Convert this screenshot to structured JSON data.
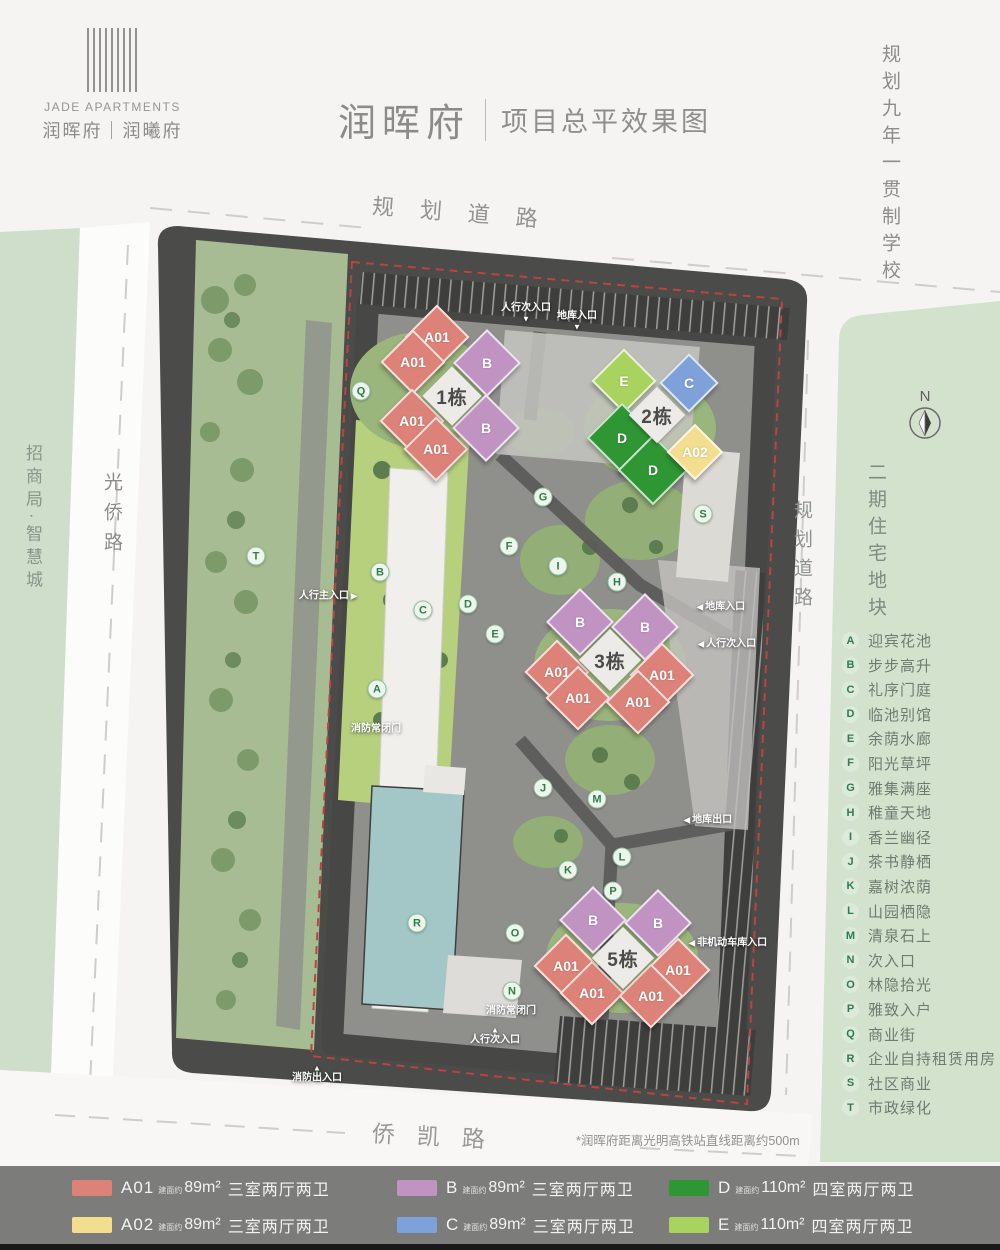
{
  "header": {
    "logo_en": "JADE APARTMENTS",
    "logo_cn": "润晖府｜润曦府",
    "title": "润晖府",
    "subtitle": "项目总平效果图"
  },
  "roads": {
    "top": "规划道路",
    "bottom": "侨凯路",
    "left": "光侨路",
    "right": "规划道路"
  },
  "areas": {
    "school": "规划九年一贯制学校",
    "east_block": "二期住宅地块",
    "west_block": "招商局·智慧城"
  },
  "compass_label": "N",
  "note": "*润晖府距离光明高铁站直线距离约500m",
  "legend": {
    "amenities": [
      {
        "key": "A",
        "label": "迎宾花池"
      },
      {
        "key": "B",
        "label": "步步高升"
      },
      {
        "key": "C",
        "label": "礼序门庭"
      },
      {
        "key": "D",
        "label": "临池别馆"
      },
      {
        "key": "E",
        "label": "余荫水廊"
      },
      {
        "key": "F",
        "label": "阳光草坪"
      },
      {
        "key": "G",
        "label": "雅集满座"
      },
      {
        "key": "H",
        "label": "稚童天地"
      },
      {
        "key": "I",
        "label": "香兰幽径"
      },
      {
        "key": "J",
        "label": "茶书静栖"
      },
      {
        "key": "K",
        "label": "嘉树浓荫"
      },
      {
        "key": "L",
        "label": "山园栖隐"
      },
      {
        "key": "M",
        "label": "清泉石上"
      },
      {
        "key": "N",
        "label": "次入口"
      },
      {
        "key": "O",
        "label": "林隐拾光"
      },
      {
        "key": "P",
        "label": "雅致入户"
      },
      {
        "key": "Q",
        "label": "商业街"
      },
      {
        "key": "R",
        "label": "企业自持租赁用房"
      },
      {
        "key": "S",
        "label": "社区商业"
      },
      {
        "key": "T",
        "label": "市政绿化"
      }
    ],
    "units": [
      {
        "code": "A01",
        "prefix": "建面约",
        "area": "89m²",
        "desc": "三室两厅两卫",
        "color": "#dd8278"
      },
      {
        "code": "B",
        "prefix": "建面约",
        "area": "89m²",
        "desc": "三室两厅两卫",
        "color": "#c093c2"
      },
      {
        "code": "D",
        "prefix": "建面约",
        "area": "110m²",
        "desc": "四室两厅两卫",
        "color": "#2f9634"
      },
      {
        "code": "A02",
        "prefix": "建面约",
        "area": "89m²",
        "desc": "三室两厅两卫",
        "color": "#f3dd8e"
      },
      {
        "code": "C",
        "prefix": "建面约",
        "area": "89m²",
        "desc": "三室两厅两卫",
        "color": "#7ea1da"
      },
      {
        "code": "E",
        "prefix": "建面约",
        "area": "110m²",
        "desc": "四室两厅两卫",
        "color": "#a8d35f"
      }
    ]
  },
  "map": {
    "buildings": [
      {
        "label": "A01",
        "x": 437,
        "y": 337,
        "color": "#dd8278",
        "size": 46
      },
      {
        "label": "A01",
        "x": 413,
        "y": 362,
        "color": "#dd8278",
        "size": 46
      },
      {
        "label": "B",
        "x": 487,
        "y": 363,
        "color": "#c093c2",
        "size": 48
      },
      {
        "label": "A01",
        "x": 412,
        "y": 421,
        "color": "#dd8278",
        "size": 46
      },
      {
        "label": "A01",
        "x": 436,
        "y": 449,
        "color": "#dd8278",
        "size": 46
      },
      {
        "label": "B",
        "x": 486,
        "y": 428,
        "color": "#c093c2",
        "size": 48
      },
      {
        "label": "1栋",
        "x": 452,
        "y": 396,
        "color": "#edebe7",
        "size": 42,
        "cls": "cluster"
      },
      {
        "label": "E",
        "x": 624,
        "y": 381,
        "color": "#a8d35f",
        "size": 46
      },
      {
        "label": "C",
        "x": 689,
        "y": 383,
        "color": "#7ea1da",
        "size": 42
      },
      {
        "label": "D",
        "x": 622,
        "y": 438,
        "color": "#2f9634",
        "size": 50
      },
      {
        "label": "D",
        "x": 653,
        "y": 470,
        "color": "#2f9634",
        "size": 50
      },
      {
        "label": "A02",
        "x": 695,
        "y": 452,
        "color": "#f3dd8e",
        "size": 40
      },
      {
        "label": "2栋",
        "x": 657,
        "y": 415,
        "color": "#edebe7",
        "size": 40,
        "cls": "cluster"
      },
      {
        "label": "B",
        "x": 580,
        "y": 622,
        "color": "#c093c2",
        "size": 48
      },
      {
        "label": "B",
        "x": 645,
        "y": 627,
        "color": "#c093c2",
        "size": 48
      },
      {
        "label": "A01",
        "x": 557,
        "y": 672,
        "color": "#dd8278",
        "size": 46
      },
      {
        "label": "A01",
        "x": 662,
        "y": 675,
        "color": "#dd8278",
        "size": 46
      },
      {
        "label": "A01",
        "x": 578,
        "y": 698,
        "color": "#dd8278",
        "size": 46
      },
      {
        "label": "A01",
        "x": 638,
        "y": 702,
        "color": "#dd8278",
        "size": 46
      },
      {
        "label": "3栋",
        "x": 610,
        "y": 660,
        "color": "#edebe7",
        "size": 44,
        "cls": "cluster"
      },
      {
        "label": "B",
        "x": 593,
        "y": 920,
        "color": "#c093c2",
        "size": 48
      },
      {
        "label": "B",
        "x": 658,
        "y": 923,
        "color": "#c093c2",
        "size": 48
      },
      {
        "label": "A01",
        "x": 566,
        "y": 966,
        "color": "#dd8278",
        "size": 46
      },
      {
        "label": "A01",
        "x": 678,
        "y": 970,
        "color": "#dd8278",
        "size": 46
      },
      {
        "label": "A01",
        "x": 592,
        "y": 993,
        "color": "#dd8278",
        "size": 46
      },
      {
        "label": "A01",
        "x": 651,
        "y": 996,
        "color": "#dd8278",
        "size": 46
      },
      {
        "label": "5栋",
        "x": 623,
        "y": 958,
        "color": "#edebe7",
        "size": 44,
        "cls": "cluster"
      }
    ],
    "markers": [
      {
        "key": "Q",
        "x": 361,
        "y": 391
      },
      {
        "key": "T",
        "x": 256,
        "y": 556
      },
      {
        "key": "B",
        "x": 380,
        "y": 572
      },
      {
        "key": "C",
        "x": 423,
        "y": 610
      },
      {
        "key": "D",
        "x": 468,
        "y": 604
      },
      {
        "key": "E",
        "x": 495,
        "y": 634
      },
      {
        "key": "F",
        "x": 509,
        "y": 546
      },
      {
        "key": "G",
        "x": 543,
        "y": 497
      },
      {
        "key": "I",
        "x": 558,
        "y": 566
      },
      {
        "key": "H",
        "x": 617,
        "y": 582
      },
      {
        "key": "A",
        "x": 377,
        "y": 689
      },
      {
        "key": "S",
        "x": 703,
        "y": 514
      },
      {
        "key": "J",
        "x": 543,
        "y": 788
      },
      {
        "key": "M",
        "x": 597,
        "y": 799
      },
      {
        "key": "L",
        "x": 622,
        "y": 857
      },
      {
        "key": "K",
        "x": 568,
        "y": 870
      },
      {
        "key": "P",
        "x": 613,
        "y": 891
      },
      {
        "key": "R",
        "x": 417,
        "y": 923
      },
      {
        "key": "O",
        "x": 515,
        "y": 933
      },
      {
        "key": "N",
        "x": 512,
        "y": 991
      }
    ],
    "entrances": [
      {
        "label": "人行次入口",
        "x": 526,
        "y": 313,
        "arrow_bottom": "▼"
      },
      {
        "label": "地库入口",
        "x": 577,
        "y": 321,
        "arrow_bottom": "▼"
      },
      {
        "label": "人行主入口",
        "x": 327,
        "y": 596,
        "arrow_right": "▶"
      },
      {
        "label": "消防常闭门",
        "x": 376,
        "y": 729
      },
      {
        "label": "地库入口",
        "x": 722,
        "y": 607,
        "arrow_left": "◀"
      },
      {
        "label": "人行次入口",
        "x": 728,
        "y": 644,
        "arrow_left": "◀"
      },
      {
        "label": "地库出口",
        "x": 709,
        "y": 820,
        "arrow_left": "◀"
      },
      {
        "label": "非机动车库入口",
        "x": 729,
        "y": 943,
        "arrow_left": "◀"
      },
      {
        "label": "消防常闭门",
        "x": 511,
        "y": 1011
      },
      {
        "label": "人行次入口",
        "x": 495,
        "y": 1036,
        "arrow_top": "▲"
      },
      {
        "label": "消防出入口",
        "x": 317,
        "y": 1074,
        "arrow_top": "▲"
      }
    ]
  }
}
